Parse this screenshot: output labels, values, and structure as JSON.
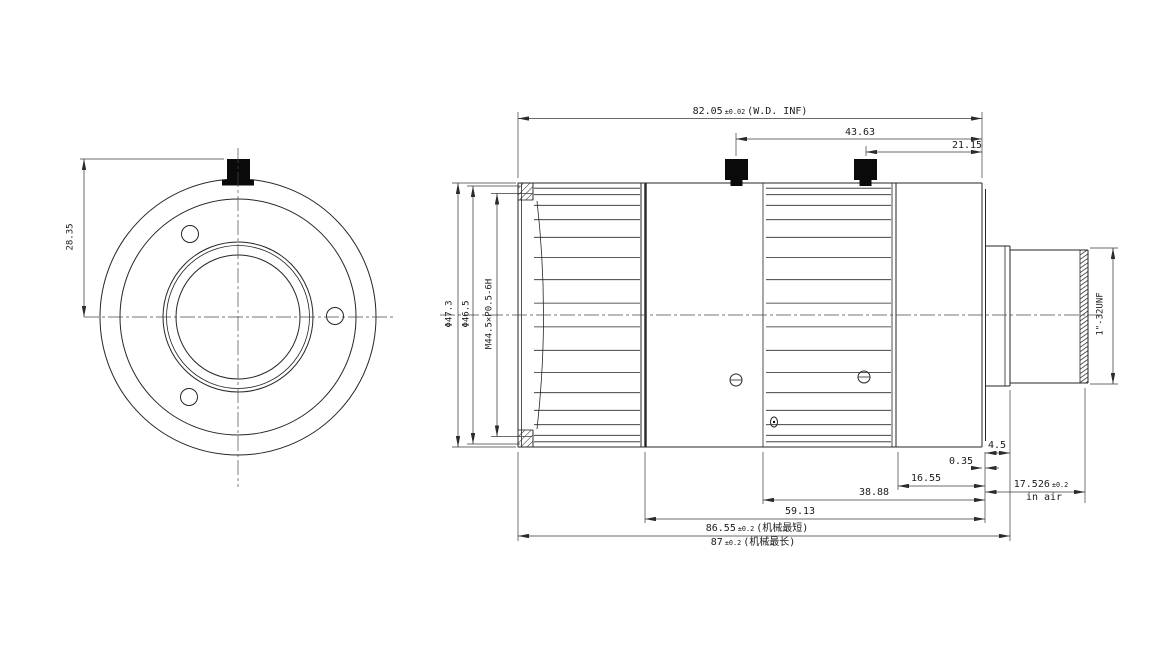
{
  "drawing_title": "lens mechanical drawing",
  "front_view": {
    "dim_knob_height": "28.35"
  },
  "side_view": {
    "dim_wd": {
      "value": "82.05",
      "tol": "±0.02",
      "suffix": "(W.D. INF)"
    },
    "dim_knob1": "43.63",
    "dim_knob2": "21.15",
    "dim_outer_diameter": "Φ47.3",
    "dim_front_diameter": "Φ46.5",
    "dim_filter_thread": "M44.5×P0.5-6H",
    "dim_mount_thread": "1\"-32UNF",
    "dim_mount_ring_width": "4.5",
    "dim_flange_step": "0.35",
    "dim_rear_section": "16.55",
    "dim_ffd": {
      "value": "17.526",
      "tol": "±0.2",
      "suffix": "in air"
    },
    "dim_iris_section": "38.88",
    "dim_body_length": "59.13",
    "dim_mech_min": {
      "value": "86.55",
      "tol": "±0.2",
      "suffix": "(机械最短)"
    },
    "dim_mech_max": {
      "value": "87",
      "tol": "±0.2",
      "suffix": "(机械最长)"
    }
  }
}
